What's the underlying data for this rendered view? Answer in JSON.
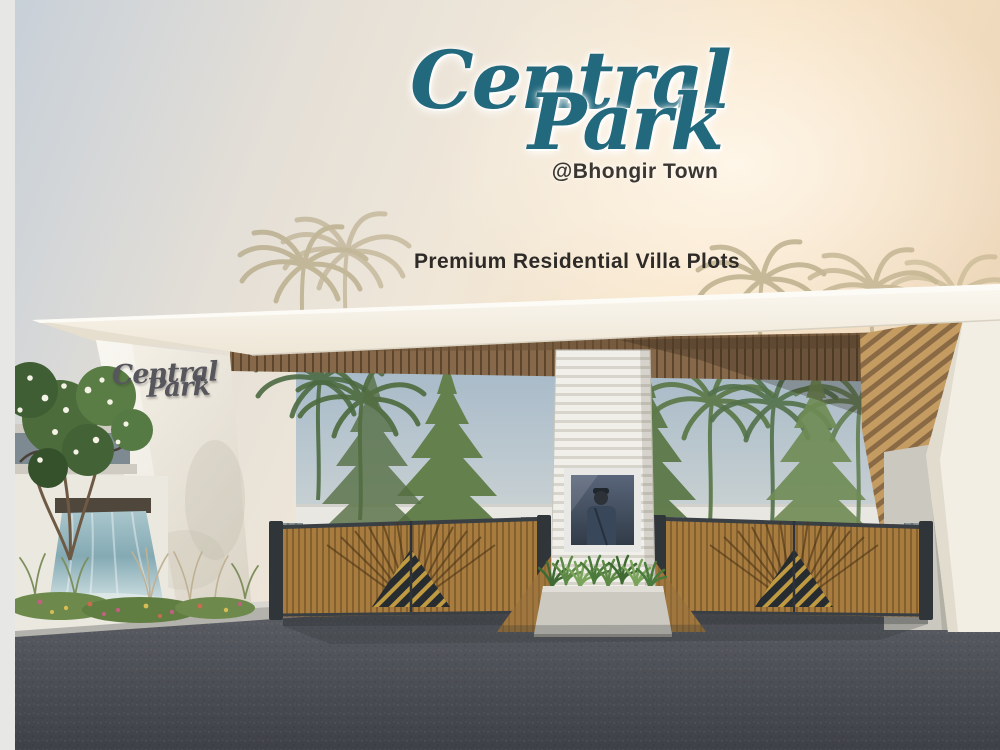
{
  "branding": {
    "name_line1": "Central",
    "name_line2": "Park",
    "location": "@Bhongir Town",
    "tagline": "Premium Residential Villa Plots",
    "brand_color": "#23697d",
    "tagline_color": "#2d2a27"
  },
  "wall_sign": {
    "line1": "Central",
    "line2": "Park",
    "color": "#56565c"
  },
  "scene": {
    "description_labels": {
      "entrance": "gated entrance canopy",
      "security": "guard visible in booth window",
      "water_feature": "wall waterfall",
      "gates": "wooden slatted sliding gates with chevron pattern"
    },
    "colors": {
      "sky_left": "#c6cfd8",
      "sky_warm": "#f7e3c6",
      "roof_white": "#faf6ee",
      "wood_gate": "#a87c3f",
      "wood_soffit": "#86684a",
      "asphalt": "#4c4f55",
      "water": "#8fb3bd",
      "foliage": "#54703f",
      "stone": "#cbc8bf",
      "hazard_yellow": "#c09a40"
    }
  }
}
